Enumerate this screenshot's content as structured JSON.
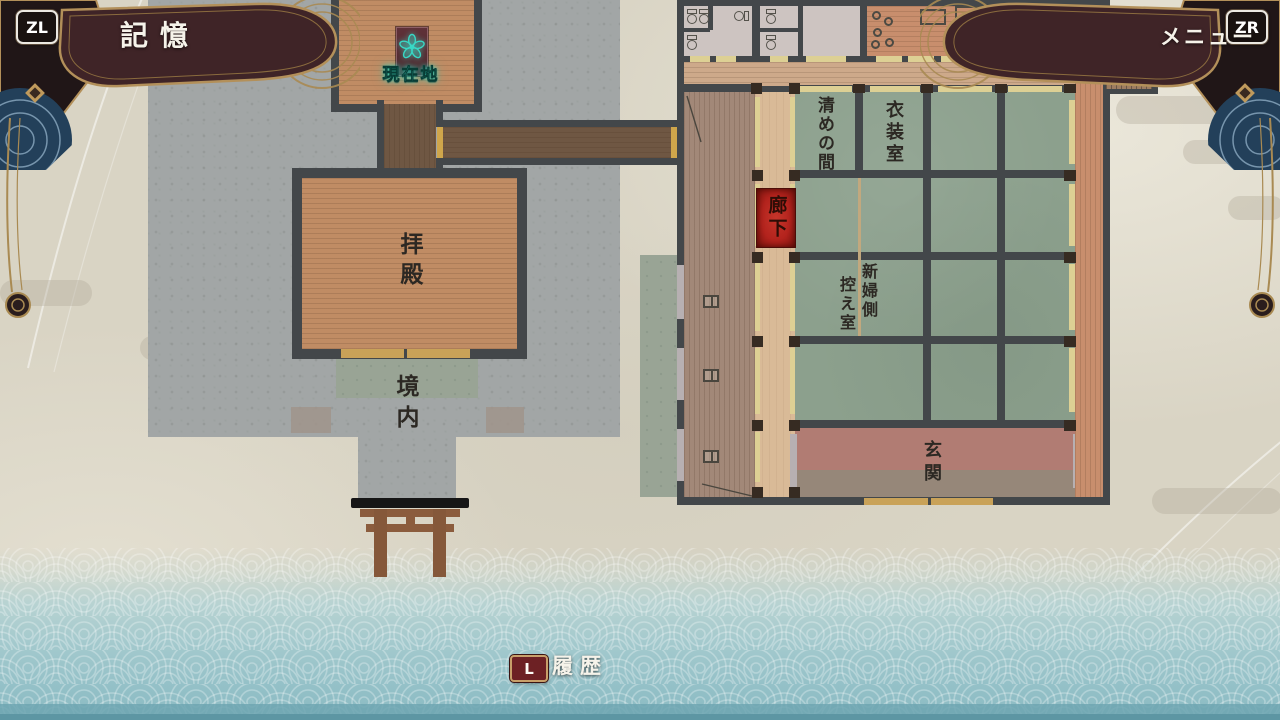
{
  "hud": {
    "memory": {
      "key": "ZL",
      "label": "記憶"
    },
    "menu": {
      "key": "ZR",
      "label": "メニュー"
    },
    "history": {
      "key": "L",
      "label": "履歴"
    }
  },
  "map": {
    "current_location_label": "現在地",
    "labels": {
      "worship_hall": "拝殿",
      "shrine_grounds": "境内",
      "purification_room": "清めの間",
      "dressing_room": "衣装室",
      "bride_room_col1": "新婦側",
      "bride_room_col2": "控え室",
      "corridor": "廊下",
      "entrance": "玄関"
    }
  },
  "colors": {
    "corridor_highlight_red": "#b3231d",
    "current_location_teal": "#3bd6c3",
    "banner_maroon": "#3f2427",
    "banner_gold": "#b3905a",
    "tatami_green": "#8ca08d",
    "floor_wood": "#c08c64",
    "wall_gray": "#43474a",
    "water_teal": "#9dc5cb"
  }
}
